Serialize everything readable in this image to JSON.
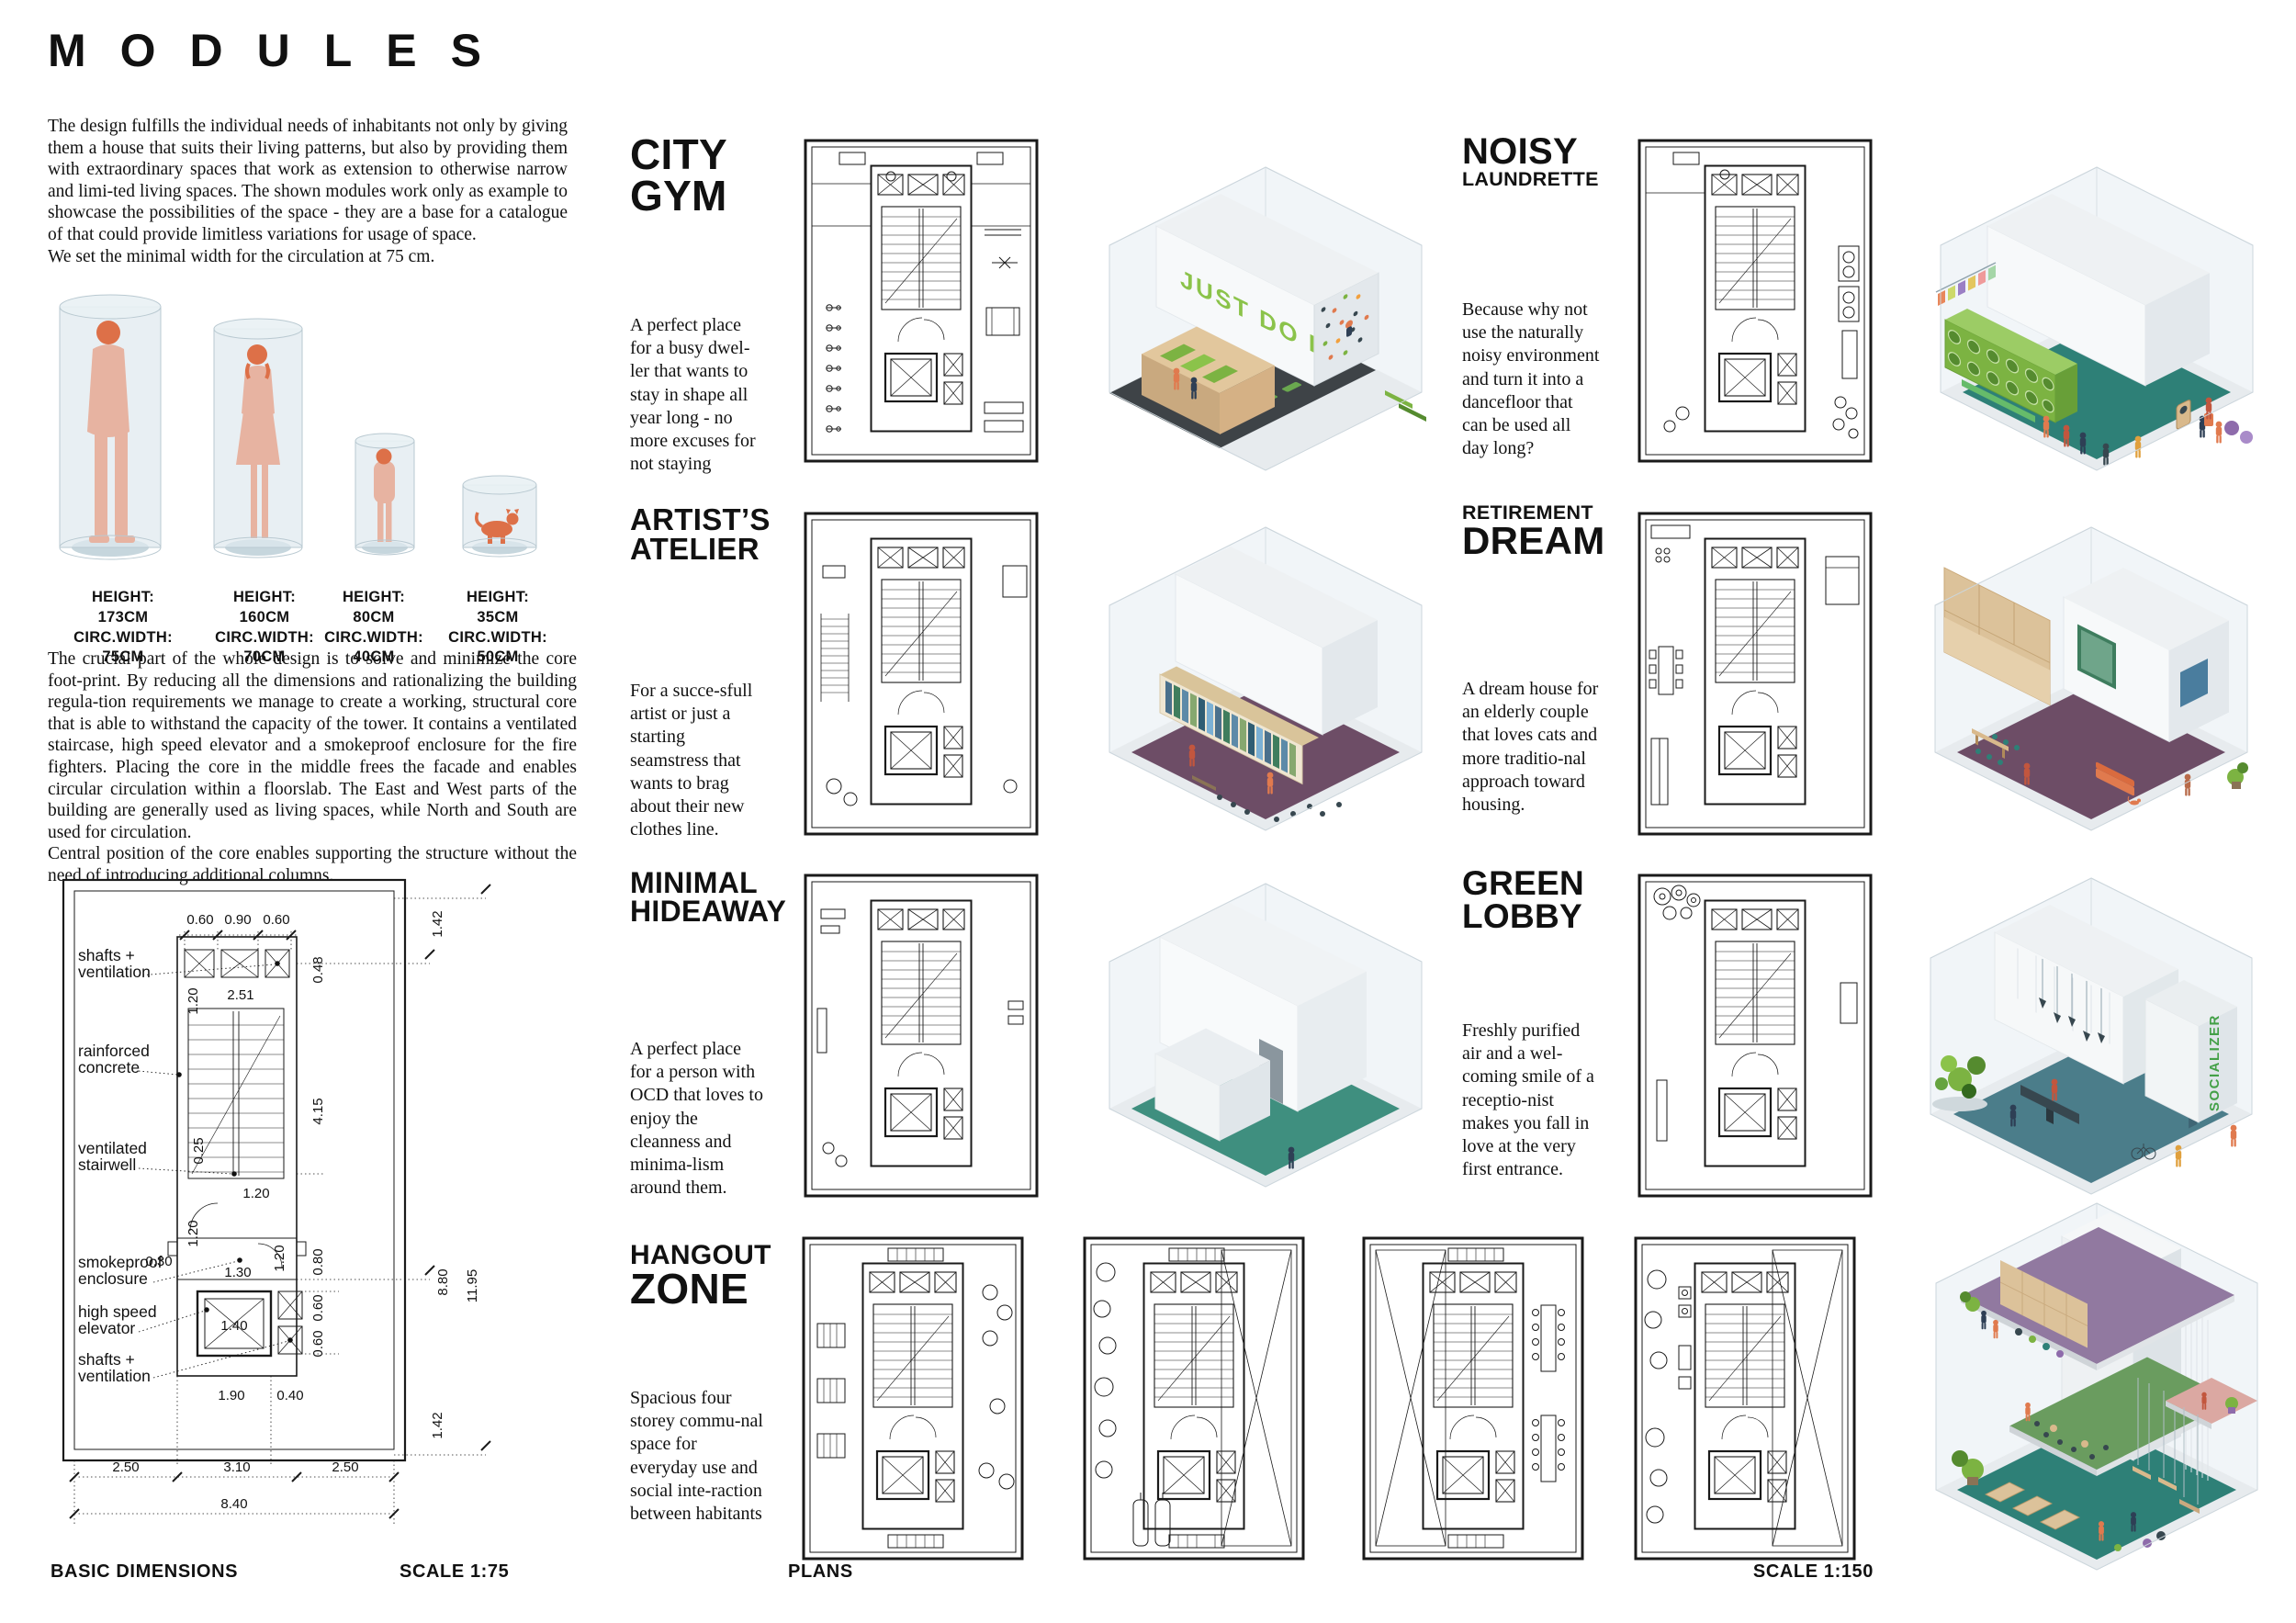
{
  "poster": {
    "title": "MODULES"
  },
  "intro": {
    "p1a": "The design fulfills the individual needs of inhabitants not only by giving them a house that suits their living patterns, but also by providing them with extraordinary spaces that work as extension to otherwise narrow and limi-ted living spaces. The shown modules work only as example to showcase the possibilities of the space - they are a base for a catalogue of that could provide limitless variations for usage of space.",
    "p1b": "We set the minimal width for the circulation at 75 cm.",
    "p2a": "The crucial part of the whole design is to solve and minimize the core foot-print. By reducing all the dimensions and rationalizing the building regula-tion requirements we manage to create a working, structural core that is able to withstand the capacity of the tower. It contains a ventilated staircase, high speed elevator and a smokeproof enclosure for the fire fighters. Placing the core in the middle frees the facade and enables circular circulation within a floorslab. The East and West parts of the building are generally used as living spaces, while North and South are used for circulation.",
    "p2b": "Central position of the core enables supporting the structure without the need of introducing additional columns."
  },
  "figures": [
    {
      "l1": "HEIGHT:",
      "v1": "173CM",
      "l2": "CIRC.WIDTH:",
      "v2": "75CM"
    },
    {
      "l1": "HEIGHT:",
      "v1": "160CM",
      "l2": "CIRC.WIDTH:",
      "v2": "70CM"
    },
    {
      "l1": "HEIGHT:",
      "v1": "80CM",
      "l2": "CIRC.WIDTH:",
      "v2": "40CM"
    },
    {
      "l1": "HEIGHT:",
      "v1": "35CM",
      "l2": "CIRC.WIDTH:",
      "v2": "50CM"
    }
  ],
  "tech": {
    "labels": [
      "shafts +",
      "ventilation",
      "rainforced",
      "concrete",
      "ventilated",
      "stairwell",
      "smokeproof",
      "enclosure",
      "high speed",
      "elevator",
      "shafts +",
      "ventilation"
    ],
    "dims": {
      "top": [
        "0.60",
        "0.90",
        "0.60"
      ],
      "inner": [
        "1.20",
        "2.51",
        "0.25",
        "1.20",
        "1.20",
        "0.30",
        "1.30",
        "1.20",
        "1.40",
        "1.90",
        "0.40"
      ],
      "right": [
        "1.42",
        "0.48",
        "4.15",
        "8.80",
        "11.95",
        "0.80",
        "0.60",
        "0.60",
        "1.42"
      ],
      "bottom": [
        "2.50",
        "3.10",
        "2.50",
        "8.40"
      ]
    }
  },
  "captions": {
    "basic_dimensions": "BASIC DIMENSIONS",
    "scale_75": "SCALE 1:75",
    "plans": "PLANS",
    "scale_150": "SCALE 1:150"
  },
  "modules": [
    {
      "name": "city-gym",
      "line1": "CITY",
      "line2": "GYM",
      "desc": "A perfect place for a busy dwel-ler that wants to stay in shape all year long - no more excuses for not staying"
    },
    {
      "name": "noisy-laundrette",
      "line1": "NOISY",
      "line2": "LAUNDRETTE",
      "desc": "Because why not use the naturally noisy environment and turn it into a dancefloor that can be used all day long?"
    },
    {
      "name": "artists-atelier",
      "line1": "ARTIST’S",
      "line2": "ATELIER",
      "desc": "For a succe-sfull artist or just a starting seamstress that wants to brag about their new clothes line."
    },
    {
      "name": "retirement-dream",
      "line1": "RETIREMENT",
      "line2": "DREAM",
      "desc": "A dream house for an elderly couple that loves cats and more traditio-nal approach toward housing."
    },
    {
      "name": "minimal-hideaway",
      "line1": "MINIMAL",
      "line2": "HIDEAWAY",
      "desc": "A perfect place for a person with OCD that loves to enjoy the cleanness and minima-lism around them."
    },
    {
      "name": "green-lobby",
      "line1": "GREEN",
      "line2": "LOBBY",
      "desc": "Freshly purified air and a wel-coming smile of a receptio-nist makes you fall in love at the very first entrance."
    },
    {
      "name": "hangout-zone",
      "line1": "HANGOUT",
      "line2": "ZONE",
      "desc": "Spacious four storey commu-nal space for everyday use and social inte-raction between habitants"
    }
  ],
  "render_text": {
    "gym": "JUST DO IT.",
    "lobby": "SOCIALIZER"
  },
  "palette": {
    "accent_green": "#8bc34a",
    "machine_green": "#7cb342",
    "teal_floor": "#2e8077",
    "green_teal_floor": "#3f8f7f",
    "steel_floor": "#4b7d8a",
    "purple_floor": "#6d4d66",
    "deck_purple": "#9179a0",
    "deck_green": "#6a9c5f",
    "balcony_pink": "#dba8a2",
    "wood": "#dcc29a",
    "silhouette_body": "#e7b3a1",
    "silhouette_head": "#dd7048",
    "glass": "#e8eff3"
  }
}
